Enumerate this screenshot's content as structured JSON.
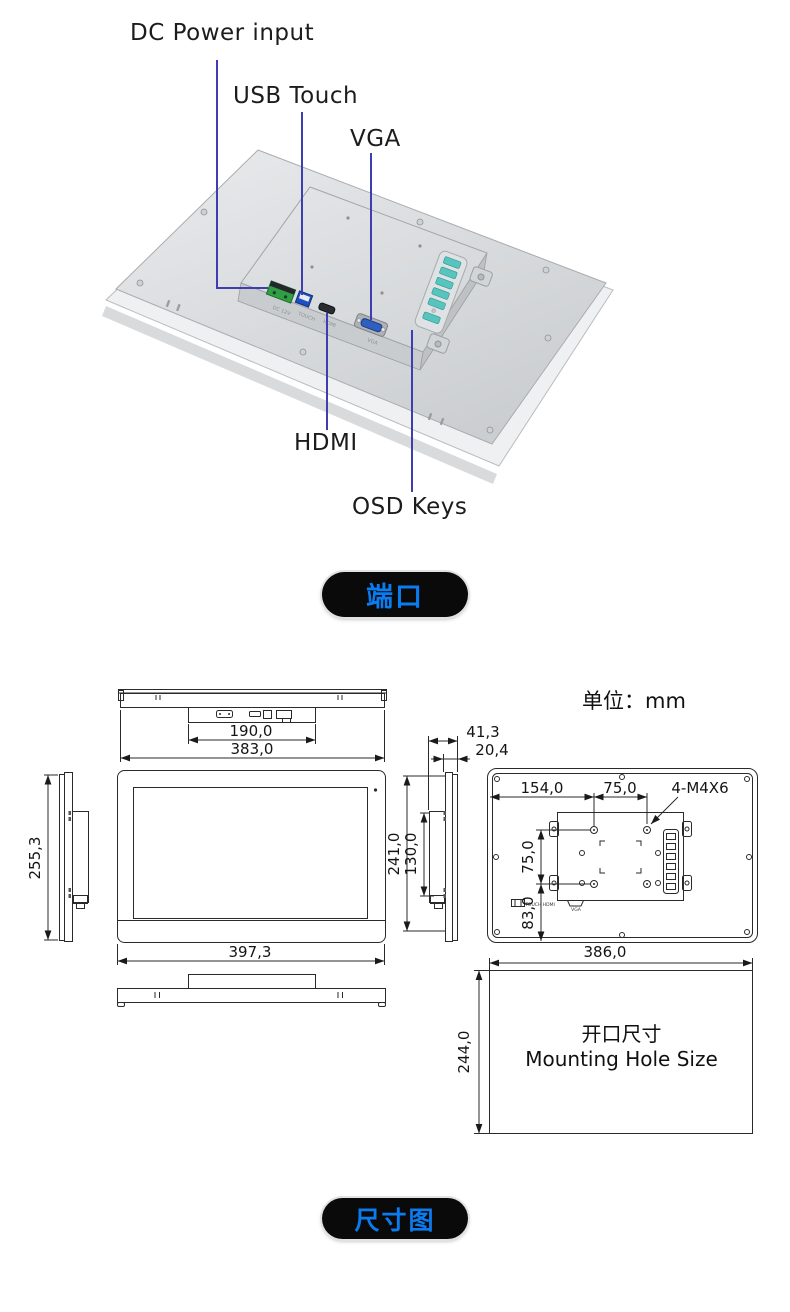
{
  "ports_view": {
    "labels": {
      "dc_power": "DC Power input",
      "usb_touch": "USB Touch",
      "vga": "VGA",
      "hdmi": "HDMI",
      "osd_keys": "OSD Keys"
    },
    "device_port_labels": {
      "dc": "DC 12V",
      "touch": "TOUCH",
      "hdmi": "HDMI",
      "vga": "VGA"
    },
    "badge": "端口"
  },
  "dimension_view": {
    "unit": "单位：mm",
    "badge": "尺寸图",
    "top_view": {
      "inner_width": "190,0",
      "outer_width": "383,0"
    },
    "left_view": {
      "height": "255,3"
    },
    "front_view": {
      "width": "397,3"
    },
    "side_view": {
      "depth_total": "41,3",
      "depth_front": "20,4",
      "height": "241,0",
      "box_height": "130,0"
    },
    "rear_view": {
      "hole_offset_left": "154,0",
      "hole_pitch_h": "75,0",
      "screw_spec": "4-M4X6",
      "hole_pitch_v": "75,0",
      "hole_offset_bottom": "83,0",
      "port_label_left": "TOUCH HDMI",
      "port_label_right": "VGA"
    },
    "cutout": {
      "width": "386,0",
      "height": "244,0",
      "title_cn": "开口尺寸",
      "title_en": "Mounting Hole Size"
    }
  },
  "colors": {
    "leader_line": "#3e3eb0",
    "badge_bg": "#0a0a0a",
    "badge_text": "#0b7bf0",
    "drawing_line": "#2a2a2a",
    "osd_button": "#57c4be",
    "dc_green": "#2f9e45",
    "usb_blue": "#1d4fc4",
    "vga_blue": "#2f5fc0"
  }
}
